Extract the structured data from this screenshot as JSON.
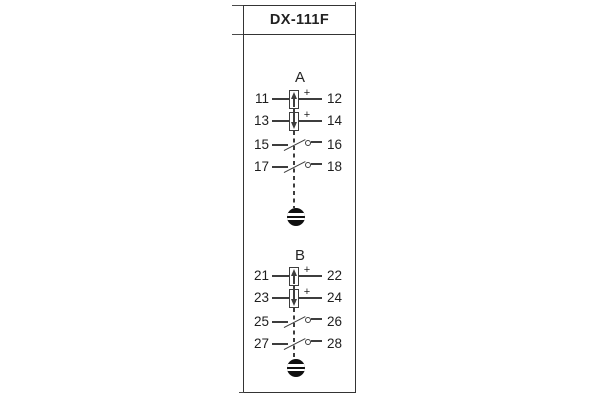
{
  "title": "DX-111F",
  "colors": {
    "line": "#3d3d3d",
    "text": "#1e1e1e",
    "background": "#ffffff",
    "screw": "#101010"
  },
  "symbols": {
    "coil_up": "box-with-up-arrow",
    "coil_down": "box-with-down-arrow",
    "contact": "normally-open-contact-with-circle",
    "reset_screw": "slotted-screw-button",
    "linkage": "dashed-mechanical-link"
  },
  "groups": [
    {
      "name": "A",
      "rows": [
        {
          "left": "11",
          "right": "12",
          "type": "coil-up",
          "plus": "+"
        },
        {
          "left": "13",
          "right": "14",
          "type": "coil-down",
          "plus": "+"
        },
        {
          "left": "15",
          "right": "16",
          "type": "contact"
        },
        {
          "left": "17",
          "right": "18",
          "type": "contact"
        }
      ]
    },
    {
      "name": "B",
      "rows": [
        {
          "left": "21",
          "right": "22",
          "type": "coil-up",
          "plus": "+"
        },
        {
          "left": "23",
          "right": "24",
          "type": "coil-down",
          "plus": "+"
        },
        {
          "left": "25",
          "right": "26",
          "type": "contact"
        },
        {
          "left": "27",
          "right": "28",
          "type": "contact"
        }
      ]
    }
  ]
}
